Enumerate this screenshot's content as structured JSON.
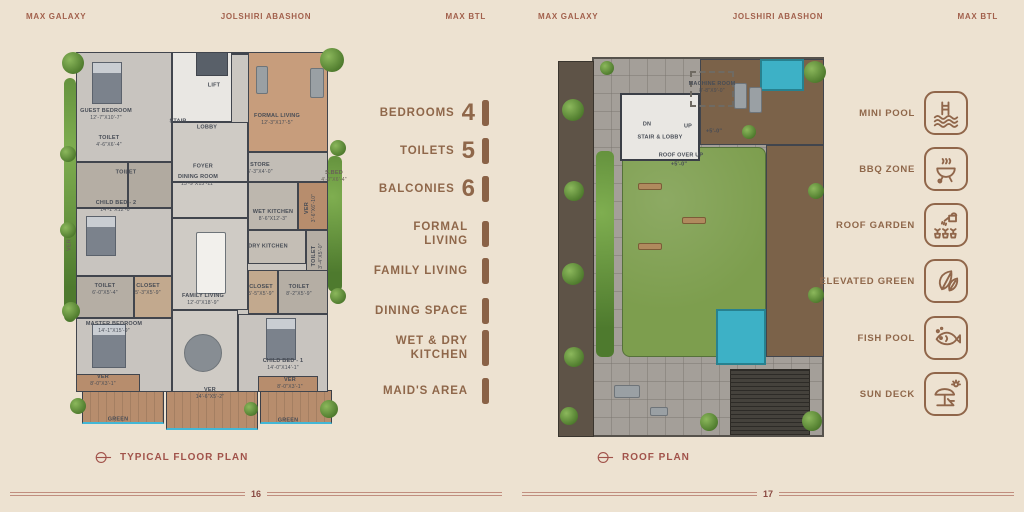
{
  "brand": {
    "left": "MAX GALAXY",
    "center": "JOLSHIRI ABASHON",
    "right": "MAX BTL"
  },
  "colors": {
    "accent_brown": "#90664A",
    "accent_red": "#A2604C",
    "lawn_green": "#7D9E4E",
    "pool_blue": "#3DB1C6"
  },
  "features": [
    {
      "label": "BEDROOMS",
      "value": "4"
    },
    {
      "label": "TOILETS",
      "value": "5"
    },
    {
      "label": "BALCONIES",
      "value": "6"
    },
    {
      "label": "FORMAL LIVING",
      "value": ""
    },
    {
      "label": "FAMILY LIVING",
      "value": ""
    },
    {
      "label": "DINING SPACE",
      "value": ""
    },
    {
      "label": "WET & DRY KITCHEN",
      "value": ""
    },
    {
      "label": "MAID'S AREA",
      "value": ""
    }
  ],
  "amenities": [
    {
      "label": "MINI POOL",
      "icon": "pool-ladder-icon"
    },
    {
      "label": "BBQ ZONE",
      "icon": "bbq-grill-icon"
    },
    {
      "label": "ROOF GARDEN",
      "icon": "watering-plants-icon"
    },
    {
      "label": "ELEVATED GREEN",
      "icon": "leaves-icon"
    },
    {
      "label": "FISH POOL",
      "icon": "fish-icon"
    },
    {
      "label": "SUN DECK",
      "icon": "sun-umbrella-icon"
    }
  ],
  "floor_plan": {
    "caption": "TYPICAL FLOOR PLAN",
    "page_number": "16",
    "rooms": [
      {
        "name": "GUEST BEDROOM",
        "dims": "12'-7\"X10'-7\""
      },
      {
        "name": "TOILET",
        "dims": "4'-6\"X6'-4\""
      },
      {
        "name": "TOILET",
        "dims": ""
      },
      {
        "name": "STAIR",
        "dims": ""
      },
      {
        "name": "LOBBY",
        "dims": ""
      },
      {
        "name": "LIFT",
        "dims": ""
      },
      {
        "name": "FORMAL LIVING",
        "dims": "12'-3\"X17'-5\""
      },
      {
        "name": "FOYER",
        "dims": ""
      },
      {
        "name": "DINING ROOM",
        "dims": "13'-9\"X15'-11\""
      },
      {
        "name": "STORE",
        "dims": "5'-3\"X4'-0\""
      },
      {
        "name": "S.BED",
        "dims": "4'-0\"X6'-4\""
      },
      {
        "name": "CHILD BED - 2",
        "dims": "14'-1\"X12'-0\""
      },
      {
        "name": "WET KITCHEN",
        "dims": "8'-6\"X12'-3\""
      },
      {
        "name": "DRY KITCHEN",
        "dims": ""
      },
      {
        "name": "VER",
        "dims": "3'-6\"X6'-10\""
      },
      {
        "name": "TOILET",
        "dims": "3'-4\"X5'-0\""
      },
      {
        "name": "VER",
        "dims": ""
      },
      {
        "name": "TOILET",
        "dims": "6'-0\"X5'-4\""
      },
      {
        "name": "CLOSET",
        "dims": "5'-3\"X5'-9\""
      },
      {
        "name": "CLOSET",
        "dims": "5'-5\"X5'-9\""
      },
      {
        "name": "TOILET",
        "dims": "8'-2\"X5'-9\""
      },
      {
        "name": "FAMILY LIVING",
        "dims": "12'-0\"X18'-9\""
      },
      {
        "name": "MASTER BEDROOM",
        "dims": "14'-1\"X15'-9\""
      },
      {
        "name": "CHILD BED - 1",
        "dims": "14'-0\"X14'-1\""
      },
      {
        "name": "VER",
        "dims": "8'-0\"X3'-1\""
      },
      {
        "name": "VER",
        "dims": "8'-0\"X3'-1\""
      },
      {
        "name": "VER",
        "dims": "14'-6\"X5'-2\""
      },
      {
        "name": "GREEN",
        "dims": ""
      },
      {
        "name": "GREEN",
        "dims": ""
      }
    ]
  },
  "roof_plan": {
    "caption": "ROOF PLAN",
    "page_number": "17",
    "labels": [
      {
        "text": "DN",
        "dims": ""
      },
      {
        "text": "STAIR & LOBBY",
        "dims": ""
      },
      {
        "text": "UP",
        "dims": ""
      },
      {
        "text": "MACHINE ROOM",
        "dims": "8'-8\"X9'-0\""
      },
      {
        "text": "+5'-0\"",
        "dims": ""
      },
      {
        "text": "ROOF OVER UP",
        "dims": ""
      },
      {
        "text": "+5'-0\"",
        "dims": ""
      }
    ]
  }
}
